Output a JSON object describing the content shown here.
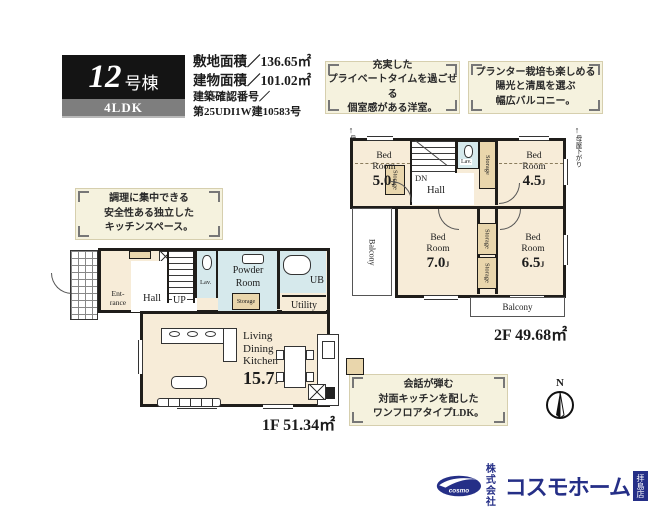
{
  "header": {
    "unit_number": "12",
    "unit_suffix": "号棟",
    "plan_type": "4LDK",
    "details": [
      "敷地面積／136.65㎡",
      "建物面積／101.02㎡",
      "建築確認番号／",
      "第25UDI1W建10583号"
    ]
  },
  "callouts": {
    "private": {
      "lines": [
        "充実した",
        "プライベートタイムを過ごせる",
        "個室感がある洋室。"
      ]
    },
    "balcony": {
      "lines": [
        "プランター栽培も楽しめる",
        "陽光と清風を選ぶ",
        "幅広バルコニー。"
      ]
    },
    "kitchen": {
      "lines": [
        "調理に集中できる",
        "安全性ある独立した",
        "キッチンスペース。"
      ]
    },
    "ldk": {
      "lines": [
        "会話が弾む",
        "対面キッチンを配した",
        "ワンフロアタイプLDK。"
      ]
    }
  },
  "floor2": {
    "bedrooms": [
      {
        "line1": "Bed",
        "line2": "Room",
        "size": "5.0",
        "unit": "J"
      },
      {
        "line1": "Bed",
        "line2": "Room",
        "size": "4.5",
        "unit": "J"
      },
      {
        "line1": "Bed",
        "line2": "Room",
        "size": "7.0",
        "unit": "J"
      },
      {
        "line1": "Bed",
        "line2": "Room",
        "size": "6.5",
        "unit": "J"
      }
    ],
    "labels": {
      "dn": "DN",
      "hall": "Hall",
      "lav": "Lav.",
      "storage": "Storage",
      "balcony_left": "Balcony",
      "balcony_bottom": "Balcony",
      "roof_note": "母屋下がり",
      "area": "2F 49.68㎡"
    }
  },
  "floor1": {
    "labels": {
      "entrance_l1": "Ent-",
      "entrance_l2": "rance",
      "hall": "Hall",
      "up": "UP",
      "lav": "Lav.",
      "powder_l1": "Powder",
      "powder_l2": "Room",
      "storage": "Storage",
      "ub": "UB",
      "utility": "Utility",
      "storage_side": "Storage",
      "area": "1F 51.34㎡"
    },
    "ldk": {
      "lines": [
        "Living",
        "Dining",
        "Kitchen"
      ],
      "size": "15.7",
      "unit": "J"
    }
  },
  "compass": {
    "north": "N"
  },
  "logo": {
    "mark": "cosmo",
    "company": [
      "株式",
      "会社"
    ],
    "brand": "コスモホーム",
    "badge": "拝島店"
  },
  "colors": {
    "wall": "#1f1d1a",
    "room_floor": "#f7ecd8",
    "wet_area": "#d6e9ec",
    "storage_tan": "#e9d6ac",
    "callout_bg": "#f5f2de",
    "title_black": "#141414",
    "plan_bar_gray": "#7e7e7e",
    "logo_navy": "#252f87"
  }
}
